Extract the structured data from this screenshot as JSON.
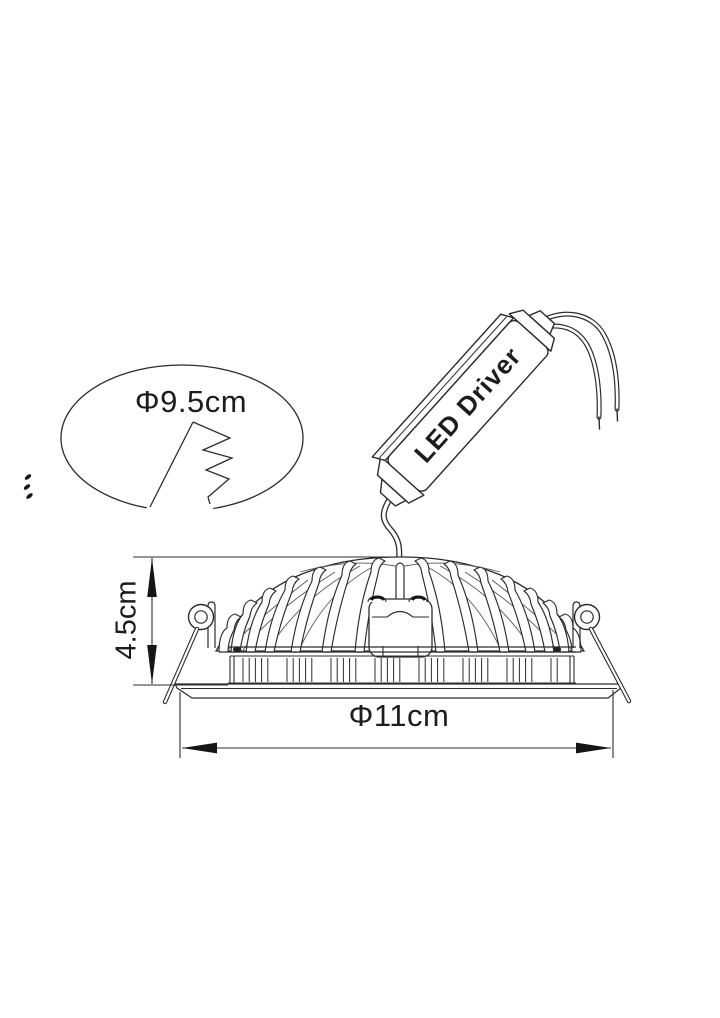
{
  "diagram": {
    "kind": "technical line drawing of a recessed LED downlight",
    "annotations": {
      "cutout_diameter": "Φ9.5cm",
      "fixture_height": "4.5cm",
      "fixture_diameter": "Φ11cm",
      "driver_label": "LED Driver"
    },
    "colors": {
      "line": "#2c2c2c",
      "background": "#ffffff",
      "text": "#1c1c1c"
    }
  }
}
